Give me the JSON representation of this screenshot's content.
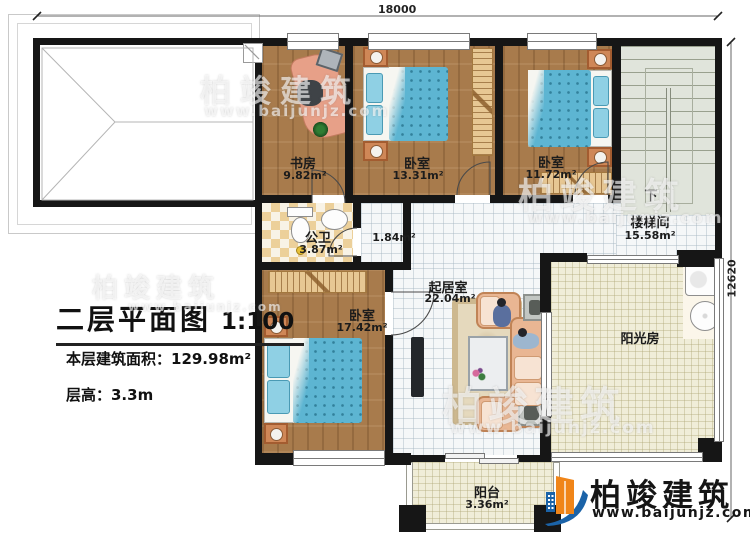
{
  "title_block": {
    "title": "二层平面图",
    "scale": "1:100",
    "floor_area_label": "本层建筑面积：129.98m²",
    "floor_height_label": "层高：3.3m"
  },
  "dimensions": {
    "width": "18000",
    "depth": "12620"
  },
  "rooms": {
    "study": {
      "name": "书房",
      "area": "9.82m²"
    },
    "bedroom1": {
      "name": "卧室",
      "area": "13.31m²"
    },
    "bedroom2": {
      "name": "卧室",
      "area": "11.72m²"
    },
    "bedroom3": {
      "name": "卧室",
      "area": "17.42m²"
    },
    "bathroom": {
      "name": "公卫",
      "area": "3.87m²"
    },
    "hallway": {
      "area": "1.84m²"
    },
    "stairwell": {
      "name": "楼梯间",
      "area": "15.58m²",
      "direction": "下"
    },
    "living_room": {
      "name": "起居室",
      "area": "22.04m²"
    },
    "sunroom": {
      "name": "阳光房"
    },
    "balcony": {
      "name": "阳台",
      "area": "3.36m²"
    }
  },
  "branding": {
    "company": "柏竣建筑",
    "website": "www.baijunjz.com"
  },
  "colors": {
    "wall": "#161616",
    "wood_floor": "#a87b4c",
    "tile_floor": "#f5f7f8",
    "sun_floor": "#f0edd8",
    "mattress": "#5db5d2",
    "sofa": "#e9b693",
    "logo_blue": "#1b63a8",
    "logo_orange": "#f08519"
  }
}
